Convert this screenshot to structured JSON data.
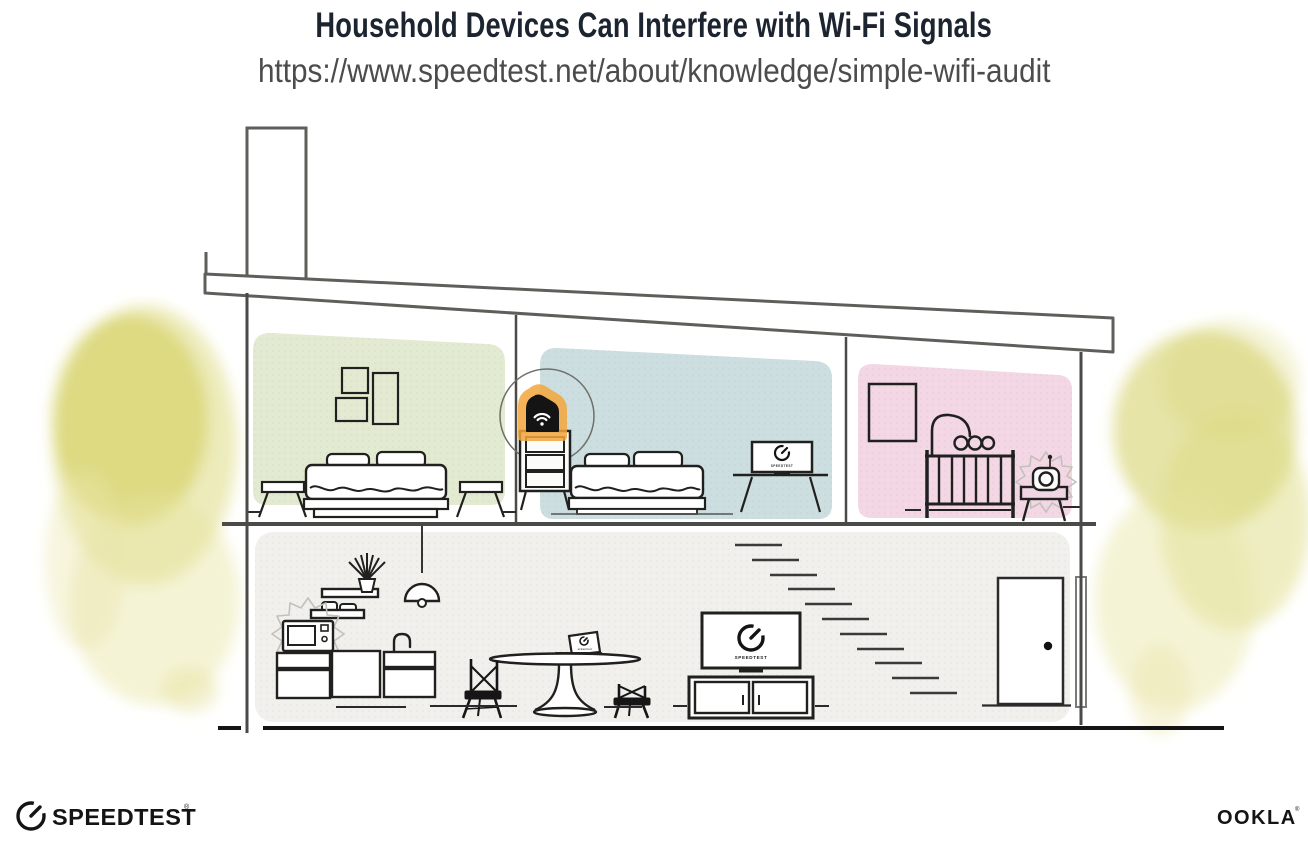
{
  "header": {
    "title": "Household Devices Can Interfere with Wi-Fi Signals",
    "url": "https://www.speedtest.net/about/knowledge/simple-wifi-audit"
  },
  "illustration": {
    "screens": {
      "bedroom_tv_label": "SPEEDTEST",
      "living_room_tv_label": "SPEEDTEST",
      "laptop_label": "SPEEDTEST"
    },
    "colors": {
      "bedroom_green_wall": "#e2ebd1",
      "bedroom_blue_wall": "#cddee1",
      "nursery_pink_wall": "#f3d7e4",
      "ground_floor_wall": "#f1f0ed",
      "router_glow_orange": "#f3a63c",
      "foliage_yellow": "#d5d166",
      "structure_line_gray": "#5e5e5a",
      "furniture_line_dark": "#20201f"
    }
  },
  "branding": {
    "speedtest_text": "SPEEDTEST",
    "speedtest_mark": "®",
    "ookla_text": "OOKLA",
    "ookla_mark": "®"
  }
}
